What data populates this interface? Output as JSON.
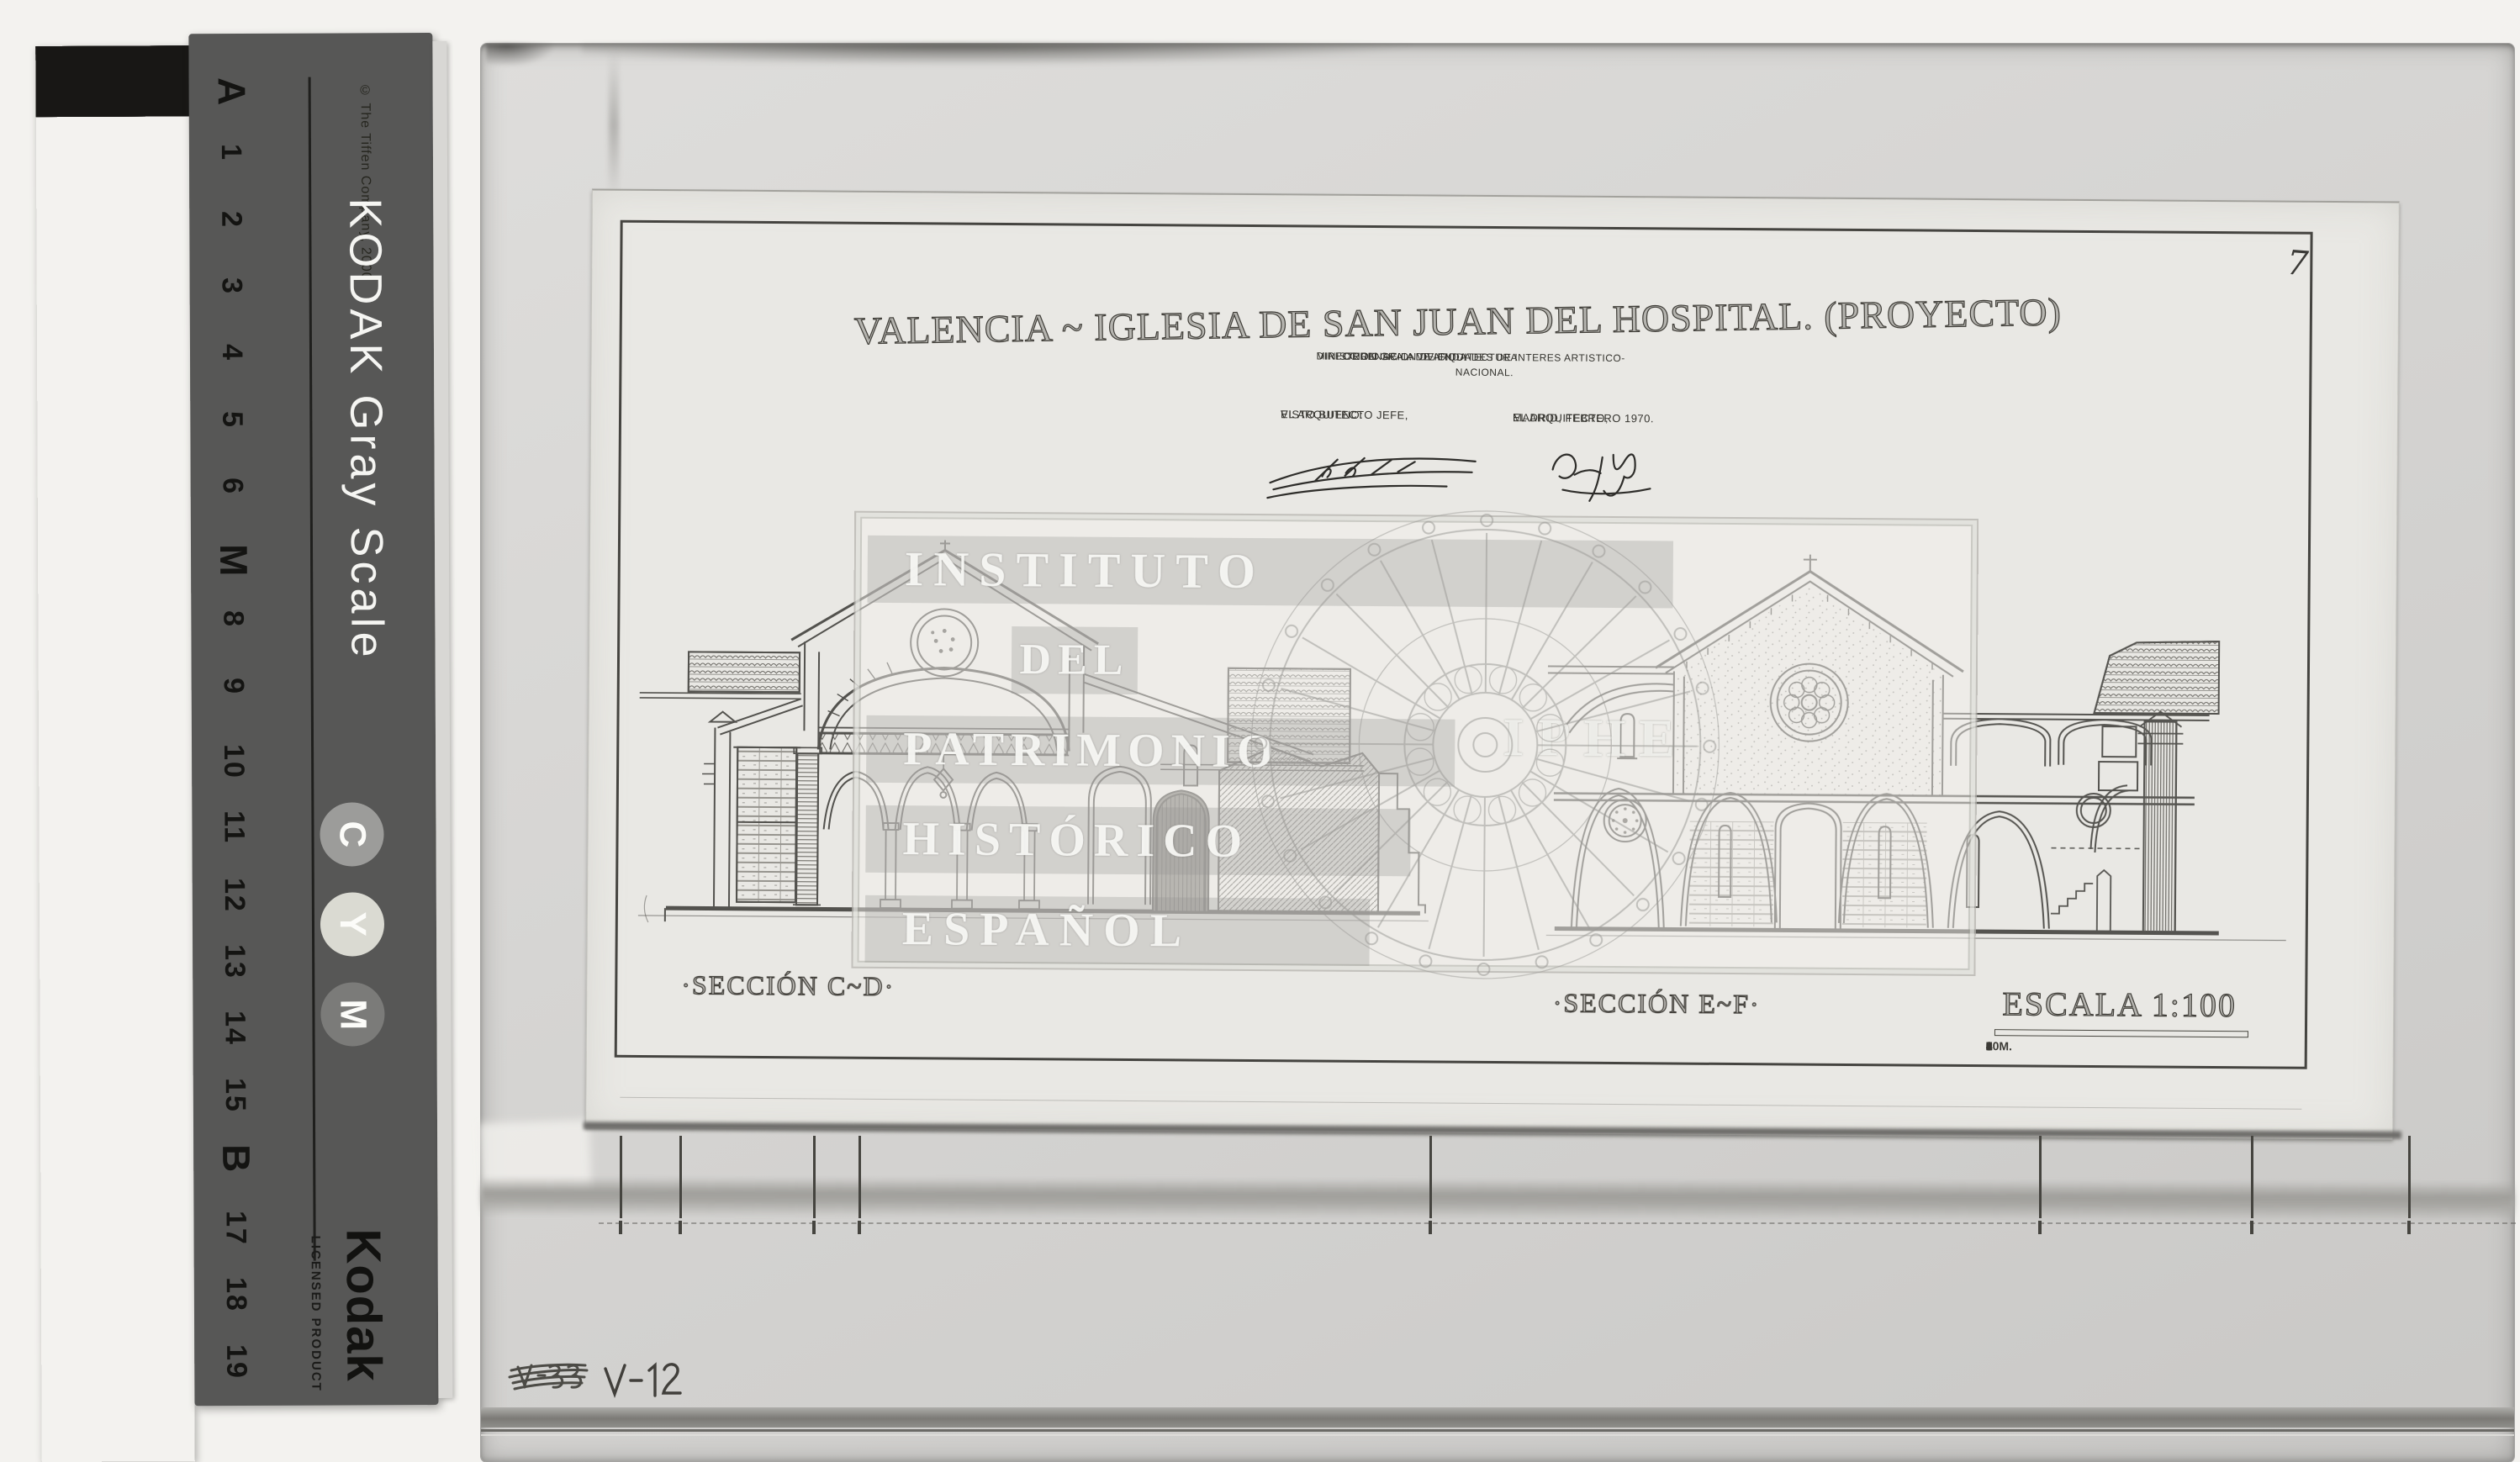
{
  "calibration_strip": {
    "copyright": "© The Tiffen Company, 2000",
    "brand": "KODAK Gray Scale",
    "steps": [
      "A",
      "1",
      "2",
      "3",
      "4",
      "5",
      "6",
      "M",
      "8",
      "9",
      "10",
      "11",
      "12",
      "13",
      "14",
      "15",
      "B",
      "17",
      "18",
      "19"
    ],
    "patch_grays": [
      "#fcfcfa",
      "#efeeec",
      "#e0dfdd",
      "#d2d1cf",
      "#c4c3c1",
      "#b5b4b2",
      "#a7a6a4",
      "#999896",
      "#8b8a88",
      "#7d7c7a",
      "#706f6d",
      "#636260",
      "#575654",
      "#4b4a48",
      "#403f3d",
      "#363533",
      "#2d2c2a",
      "#252422",
      "#1e1d1b",
      "#181715"
    ],
    "color_patches": [
      {
        "label": "C",
        "color": "#9c9c9a"
      },
      {
        "label": "Y",
        "color": "#dadad2"
      },
      {
        "label": "M",
        "color": "#7b7b79"
      }
    ],
    "footer_logo": "Kodak",
    "footer_text": "LICENSED PRODUCT"
  },
  "photo": {
    "sheet": {
      "page_number": "7",
      "title": "VALENCIA ~ IGLESIA DE SAN JUAN DEL HOSPITAL. (PROYECTO)",
      "agency_lines": [
        "MINISTERIO DE LA VIVIENDA",
        "DIRECCION GRAL. DE ARQUITECTURA",
        "ORDENACION DE CIUDADES DE INTERES ARTISTICO-NACIONAL."
      ],
      "approval_left": {
        "line1": "VISTO BUENO:",
        "line2": "EL ARQUITECTO JEFE,"
      },
      "approval_right": {
        "line1": "MADRID, FEBRERO 1970.",
        "line2": "EL ARQUITECTO,"
      },
      "section_label_left": "·SECCIÓN C~D·",
      "section_label_right": "·SECCIÓN E~F·",
      "scale_label": "ESCALA 1:100",
      "scale_ticks": [
        "1",
        "0",
        "1",
        "2",
        "3",
        "4",
        "5",
        "6",
        "7",
        "8",
        "9",
        "10M."
      ]
    },
    "watermark": {
      "lines": [
        "INSTITUTO",
        "DEL",
        "PATRIMONIO",
        "HISTÓRICO",
        "ESPAÑOL"
      ],
      "acronym": "IPHE"
    },
    "annotations": {
      "crossed_out": "V-33",
      "reference": "V-12"
    }
  }
}
